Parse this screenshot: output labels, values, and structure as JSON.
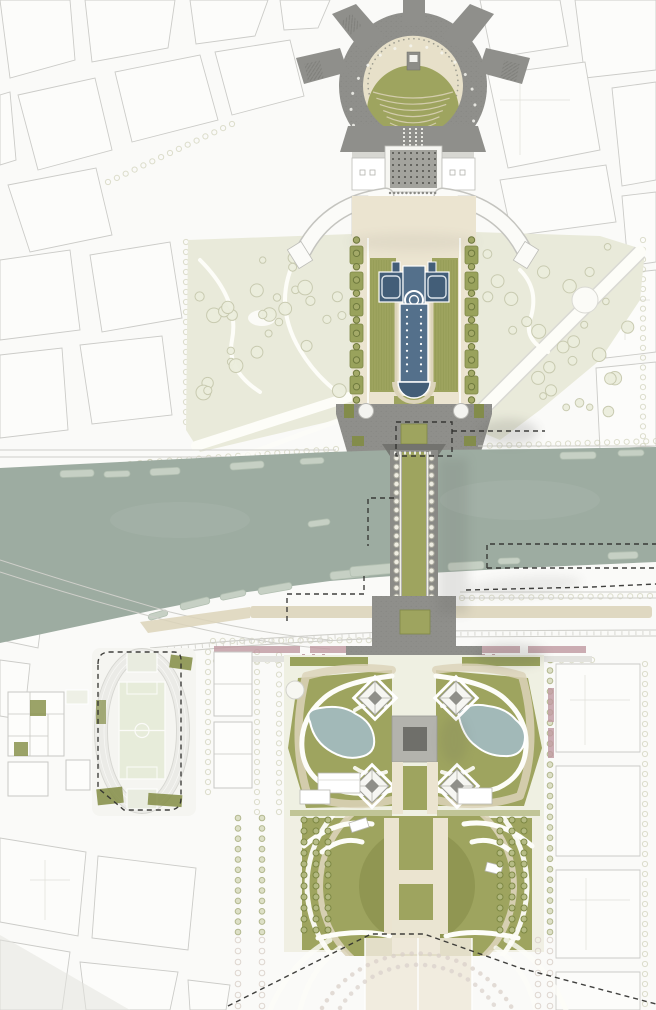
{
  "document": {
    "type": "architectural-masterplan-drawing",
    "title": "Riverfront axis masterplan — site plan",
    "visible_text": "none"
  },
  "palette": {
    "bg": "#fafaf8",
    "city_fill": "#fdfdfb",
    "city_line": "#c8c8c4",
    "plaza": "#8f8f8b",
    "plaza_light": "#b9b9b3",
    "plaza_dark": "#6f6f6a",
    "deck": "#8b8b87",
    "cream": "#ebe4d0",
    "cream_dark": "#dcd4ba",
    "olive": "#9ea45f",
    "olive_dark": "#828c44",
    "olive_soft": "#b8bd8a",
    "hedge": "#99a25c",
    "pale_garden": "#e9eada",
    "tree_line": "#c7c9ae",
    "tree_olive": "#7c8743",
    "river": "#9daca1",
    "boat": "#c6d0c4",
    "fountain": "#54708b",
    "fountain_dark": "#435e78",
    "pond": "#a2b9b8",
    "pink": "#bf99a0",
    "track_ring": "#ebebe7",
    "pitch": "#e7ecda",
    "rail_line": "#cfcfca",
    "boundary": "#30302e",
    "shadow": "#5f5f5c",
    "faded": "#d8cfc8"
  },
  "regions": {
    "circular_plaza": "Circular plaza with amphitheatre lawn",
    "palace": "Curved twin-wing palace with gridded parvis",
    "fountain_garden": "Axial water-cannon basin garden",
    "river": "River with moored barges",
    "bridge": "Pedestrian bridge with central lawn and tree rows",
    "tower_garden": "Tower site: four piers, central plaza, twin ponds",
    "great_lawn": "Great circular lawn with axial paths",
    "stadium": "Athletics track, pitch and sports courts",
    "boundary": "Dashed project-boundary line"
  }
}
